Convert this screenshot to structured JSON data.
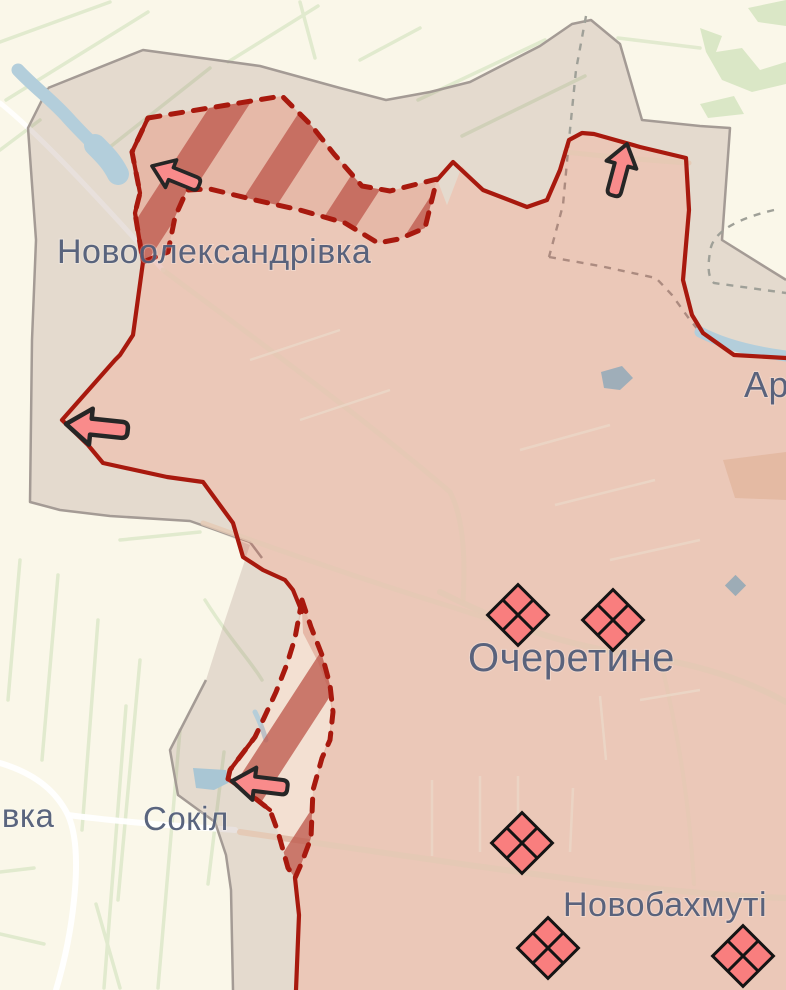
{
  "map": {
    "type": "frontline-war-map",
    "background": "#faf7e9",
    "label_color": "#515d78",
    "water_color": "#b3cedb",
    "region_labels": [
      {
        "id": "novooleksandrivka",
        "text": "Новоолександрівка",
        "x": 57,
        "y": 263,
        "size": 34
      },
      {
        "id": "ocheretyne",
        "text": "Очеретине",
        "x": 468,
        "y": 671,
        "size": 40
      },
      {
        "id": "sokil",
        "text": "Сокіл",
        "x": 143,
        "y": 830,
        "size": 33
      },
      {
        "id": "ivka-partial",
        "text": "івка",
        "x": -6,
        "y": 827,
        "size": 33
      },
      {
        "id": "novobakhmutivka-partial",
        "text": "Новобахмуті",
        "x": 563,
        "y": 916,
        "size": 34
      },
      {
        "id": "ar-partial",
        "text": "Ар",
        "x": 744,
        "y": 397,
        "size": 36
      }
    ],
    "zones": {
      "occupied": {
        "fill": "rgba(201,92,72,0.30)",
        "border": "#a8190e",
        "border_style": "solid"
      },
      "assault_hatched": {
        "stripe": "#bf5a4e",
        "base": "rgba(205,106,85,0.16)",
        "border": "#a8190e",
        "border_style": "dashed"
      },
      "buffer": {
        "fill": "rgba(150,120,108,0.22)",
        "admin_border": "#a49b95"
      }
    },
    "marker_style": {
      "fill": "#f97e7e",
      "stroke": "#141414"
    },
    "arrow_style": {
      "fill": "#f98b8b",
      "stroke": "#262626"
    },
    "unit_markers": [
      {
        "x": 518,
        "y": 615,
        "type": "enemy-unit-diamond"
      },
      {
        "x": 613,
        "y": 620,
        "type": "enemy-unit-diamond"
      },
      {
        "x": 522,
        "y": 843,
        "type": "enemy-unit-diamond"
      },
      {
        "x": 548,
        "y": 948,
        "type": "enemy-unit-diamond"
      },
      {
        "x": 743,
        "y": 956,
        "type": "enemy-unit-diamond"
      }
    ],
    "attack_arrows": [
      {
        "x": 152,
        "y": 166,
        "rotate": 22,
        "scale": 0.82,
        "direction": "west-up"
      },
      {
        "x": 627,
        "y": 144,
        "rotate": 105,
        "scale": 0.86,
        "direction": "north"
      },
      {
        "x": 66,
        "y": 424,
        "rotate": 6,
        "scale": 1.0,
        "direction": "west"
      },
      {
        "x": 232,
        "y": 781,
        "rotate": 7,
        "scale": 0.9,
        "direction": "west"
      }
    ]
  }
}
